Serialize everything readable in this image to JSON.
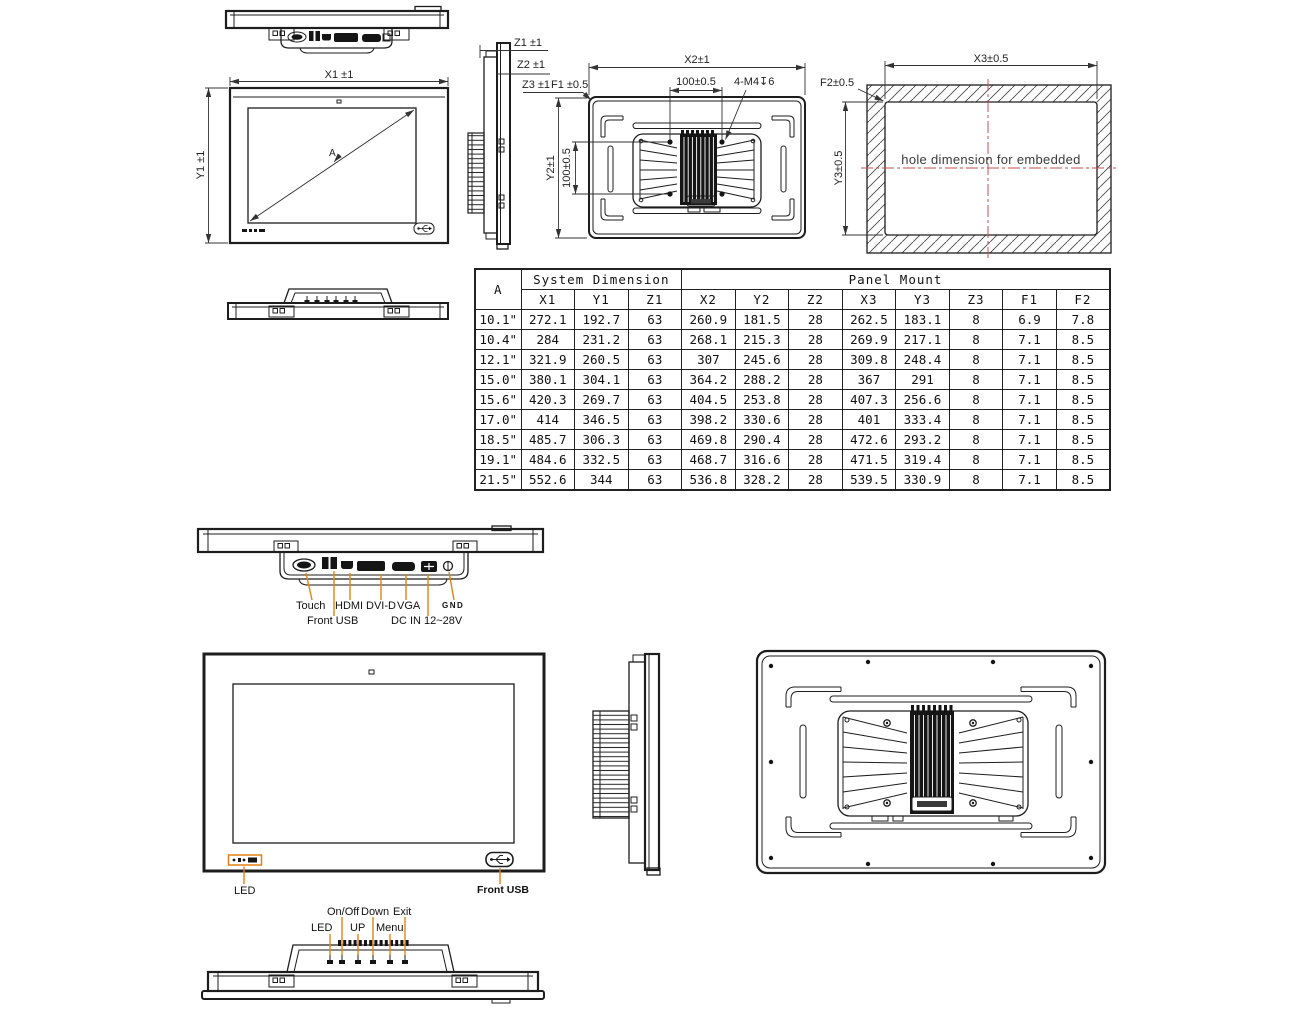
{
  "drawing_labels": {
    "front_top": {
      "x1": "X1 ±1",
      "y1": "Y1 ±1",
      "diagonal": "A"
    },
    "side_top": {
      "z1": "Z1 ±1",
      "z2": "Z2 ±1",
      "z3": "Z3 ±1",
      "f1": "F1 ±0.5"
    },
    "rear_top": {
      "x2": "X2±1",
      "vesa_x": "100±0.5",
      "thread": "4-M4↧6",
      "y2": "Y2±1",
      "vesa_y": "100±0.5"
    },
    "hole": {
      "x3": "X3±0.5",
      "y3": "Y3±0.5",
      "f2": "F2±0.5",
      "caption": "hole dimension for embedded"
    }
  },
  "table": {
    "col_a": "A",
    "group1": "System Dimension",
    "group2": "Panel Mount",
    "columns": [
      "X1",
      "Y1",
      "Z1",
      "X2",
      "Y2",
      "Z2",
      "X3",
      "Y3",
      "Z3",
      "F1",
      "F2"
    ],
    "rows": [
      {
        "a": "10.1\"",
        "values": [
          "272.1",
          "192.7",
          "63",
          "260.9",
          "181.5",
          "28",
          "262.5",
          "183.1",
          "8",
          "6.9",
          "7.8"
        ]
      },
      {
        "a": "10.4\"",
        "values": [
          "284",
          "231.2",
          "63",
          "268.1",
          "215.3",
          "28",
          "269.9",
          "217.1",
          "8",
          "7.1",
          "8.5"
        ]
      },
      {
        "a": "12.1\"",
        "values": [
          "321.9",
          "260.5",
          "63",
          "307",
          "245.6",
          "28",
          "309.8",
          "248.4",
          "8",
          "7.1",
          "8.5"
        ]
      },
      {
        "a": "15.0\"",
        "values": [
          "380.1",
          "304.1",
          "63",
          "364.2",
          "288.2",
          "28",
          "367",
          "291",
          "8",
          "7.1",
          "8.5"
        ]
      },
      {
        "a": "15.6\"",
        "values": [
          "420.3",
          "269.7",
          "63",
          "404.5",
          "253.8",
          "28",
          "407.3",
          "256.6",
          "8",
          "7.1",
          "8.5"
        ]
      },
      {
        "a": "17.0\"",
        "values": [
          "414",
          "346.5",
          "63",
          "398.2",
          "330.6",
          "28",
          "401",
          "333.4",
          "8",
          "7.1",
          "8.5"
        ]
      },
      {
        "a": "18.5\"",
        "values": [
          "485.7",
          "306.3",
          "63",
          "469.8",
          "290.4",
          "28",
          "472.6",
          "293.2",
          "8",
          "7.1",
          "8.5"
        ]
      },
      {
        "a": "19.1\"",
        "values": [
          "484.6",
          "332.5",
          "63",
          "468.7",
          "316.6",
          "28",
          "471.5",
          "319.4",
          "8",
          "7.1",
          "8.5"
        ]
      },
      {
        "a": "21.5\"",
        "values": [
          "552.6",
          "344",
          "63",
          "536.8",
          "328.2",
          "28",
          "539.5",
          "330.9",
          "8",
          "7.1",
          "8.5"
        ]
      }
    ]
  },
  "io": {
    "touch": "Touch",
    "hdmi": "HDMI",
    "dvi_d": "DVI-D",
    "vga": "VGA",
    "gnd": "GND",
    "front_usb": "Front USB",
    "dc_in": "DC IN 12~28V"
  },
  "front_view": {
    "led": "LED",
    "front_usb": "Front USB"
  },
  "osd": {
    "on_off": "On/Off",
    "down": "Down",
    "exit": "Exit",
    "led": "LED",
    "up": "UP",
    "menu": "Menu"
  },
  "colors": {
    "line": "#1d1d1d",
    "leader": "#e08214",
    "centerline": "#c0504d"
  }
}
